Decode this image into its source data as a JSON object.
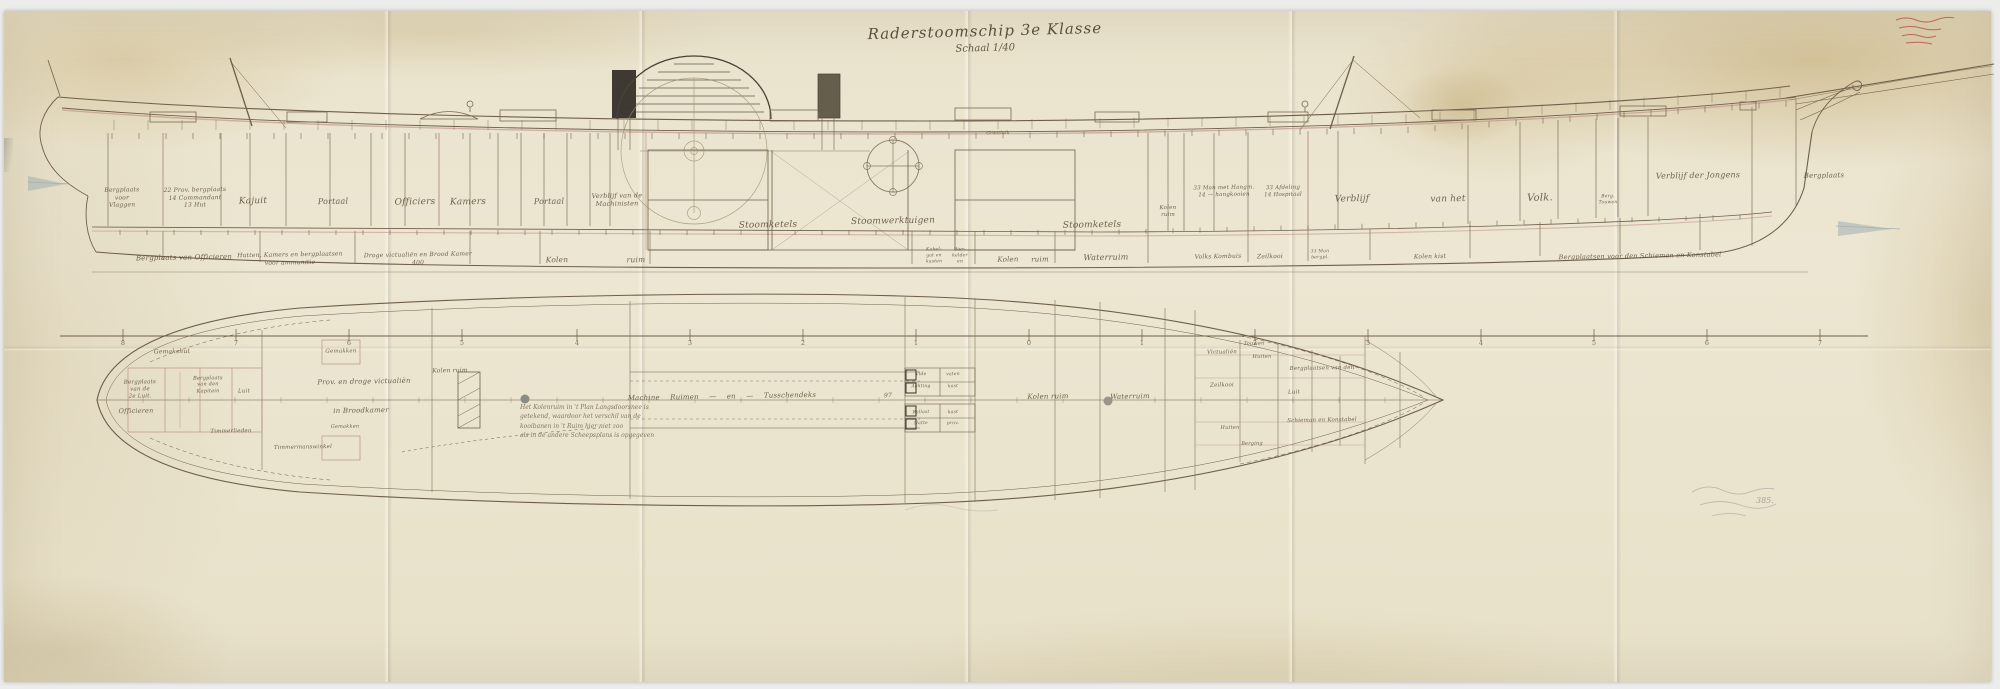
{
  "sheet": {
    "title": "Raderstoomschip 3e Klasse",
    "scale_note": "Schaal 1/40",
    "paper_color": "#e9e2cb",
    "ink_color": "#6f5f49",
    "accent_red": "#bf958c",
    "stamp_color": "#b5453a"
  },
  "profile_view": {
    "caption": "Langsdoorsnede",
    "tweendeck_labels": [
      {
        "t": "Bergplaats\nvoor\nVlaggen",
        "x": 122,
        "y": 198,
        "fs": 6
      },
      {
        "t": "22 Prov. bergplaats\n14 Commandant\n13 Hut",
        "x": 195,
        "y": 198,
        "fs": 6
      },
      {
        "t": "Kajuit",
        "x": 253,
        "y": 202,
        "fs": 9
      },
      {
        "t": "Portaal",
        "x": 333,
        "y": 202,
        "fs": 8
      },
      {
        "t": "Officiers",
        "x": 415,
        "y": 203,
        "fs": 9
      },
      {
        "t": "Kamers",
        "x": 468,
        "y": 203,
        "fs": 9
      },
      {
        "t": "Portaal",
        "x": 549,
        "y": 202,
        "fs": 8
      },
      {
        "t": "Verblijf van de\nMachinisten",
        "x": 617,
        "y": 200,
        "fs": 6.5
      },
      {
        "t": "Stoomketels",
        "x": 768,
        "y": 226,
        "fs": 9
      },
      {
        "t": "Stoomwerktuigen",
        "x": 893,
        "y": 222,
        "fs": 9
      },
      {
        "t": "Stoomketels",
        "x": 1092,
        "y": 226,
        "fs": 9
      },
      {
        "t": "Kolen\nruim",
        "x": 1168,
        "y": 212,
        "fs": 5.5
      },
      {
        "t": "33 Man met Hangm.\n14  —  hangkooien",
        "x": 1224,
        "y": 192,
        "fs": 5.5
      },
      {
        "t": "33 Afdeling\n14 Hospitaal",
        "x": 1283,
        "y": 192,
        "fs": 5.5
      },
      {
        "t": "Verblijf",
        "x": 1352,
        "y": 200,
        "fs": 9
      },
      {
        "t": "van het",
        "x": 1448,
        "y": 200,
        "fs": 9
      },
      {
        "t": "Volk.",
        "x": 1540,
        "y": 199,
        "fs": 10
      },
      {
        "t": "Berg.\nTouwen",
        "x": 1608,
        "y": 200,
        "fs": 4.5
      },
      {
        "t": "Verblijf der Jongens",
        "x": 1698,
        "y": 176,
        "fs": 8
      },
      {
        "t": "Bergplaats",
        "x": 1824,
        "y": 176,
        "fs": 7
      }
    ],
    "hold_labels": [
      {
        "t": "Bergplaats van Officieren",
        "x": 184,
        "y": 258,
        "fs": 7
      },
      {
        "t": "Hutten, Kamers en bergplaatsen\nvoor ammunitie",
        "x": 290,
        "y": 259,
        "fs": 6
      },
      {
        "t": "Droge victualiën en Brood Kamer\n400",
        "x": 418,
        "y": 259,
        "fs": 6
      },
      {
        "t": "Kolen",
        "x": 557,
        "y": 260,
        "fs": 7.5
      },
      {
        "t": "ruim",
        "x": 636,
        "y": 260,
        "fs": 7.5
      },
      {
        "t": "Kabel-\ngat en\nkasten",
        "x": 934,
        "y": 256,
        "fs": 4.5
      },
      {
        "t": "Bier-\nkelder\nen",
        "x": 960,
        "y": 256,
        "fs": 4.5
      },
      {
        "t": "Kolen",
        "x": 1008,
        "y": 260,
        "fs": 7
      },
      {
        "t": "ruim",
        "x": 1040,
        "y": 260,
        "fs": 7
      },
      {
        "t": "Waterruim",
        "x": 1106,
        "y": 258,
        "fs": 8
      },
      {
        "t": "Volks Kombuis",
        "x": 1218,
        "y": 257,
        "fs": 6
      },
      {
        "t": "Zeilkooi",
        "x": 1270,
        "y": 257,
        "fs": 6
      },
      {
        "t": "33 Man\nbergpl.",
        "x": 1320,
        "y": 255,
        "fs": 4.5
      },
      {
        "t": "Kolen kist",
        "x": 1430,
        "y": 257,
        "fs": 6
      },
      {
        "t": "Bergplaatsen voor den Schieman en Konstabel",
        "x": 1640,
        "y": 256,
        "fs": 6.5
      }
    ],
    "deck_labels": [
      {
        "t": "Grootluik",
        "x": 998,
        "y": 134,
        "fs": 4.5
      }
    ]
  },
  "station_line": {
    "y": 343,
    "numbers": [
      {
        "t": "8",
        "x": 123
      },
      {
        "t": "7",
        "x": 236
      },
      {
        "t": "6",
        "x": 349
      },
      {
        "t": "5",
        "x": 462
      },
      {
        "t": "4",
        "x": 577
      },
      {
        "t": "3",
        "x": 690
      },
      {
        "t": "2",
        "x": 803
      },
      {
        "t": "1",
        "x": 916
      },
      {
        "t": "0",
        "x": 1029
      },
      {
        "t": "1",
        "x": 1142
      },
      {
        "t": "2",
        "x": 1255
      },
      {
        "t": "3",
        "x": 1368
      },
      {
        "t": "4",
        "x": 1481
      },
      {
        "t": "5",
        "x": 1594
      },
      {
        "t": "6",
        "x": 1707
      },
      {
        "t": "7",
        "x": 1820
      }
    ]
  },
  "plan_view": {
    "caption": "Plan van het ruim",
    "labels": [
      {
        "t": "Gemakshut",
        "x": 172,
        "y": 352,
        "fs": 6
      },
      {
        "t": "Gemakken",
        "x": 341,
        "y": 352,
        "fs": 5.5
      },
      {
        "t": "Gemakken",
        "x": 345,
        "y": 427,
        "fs": 5
      },
      {
        "t": "Timmermanswinkel",
        "x": 303,
        "y": 448,
        "fs": 5.5
      },
      {
        "t": "Bergplaats\nvan de\n2e Luit.",
        "x": 140,
        "y": 390,
        "fs": 5.5
      },
      {
        "t": "Bergplaats\nvan den\nKapitein",
        "x": 208,
        "y": 385,
        "fs": 5
      },
      {
        "t": "Officieren",
        "x": 136,
        "y": 411,
        "fs": 6.5
      },
      {
        "t": "Luit",
        "x": 244,
        "y": 392,
        "fs": 5.5
      },
      {
        "t": "Timmerlieden",
        "x": 231,
        "y": 432,
        "fs": 5.5
      },
      {
        "t": "Prov. en droge victualiën",
        "x": 364,
        "y": 382,
        "fs": 7
      },
      {
        "t": "in Broodkamer",
        "x": 361,
        "y": 411,
        "fs": 7
      },
      {
        "t": "Kolen ruim",
        "x": 450,
        "y": 371,
        "fs": 6
      },
      {
        "t": "Machine Ruimen  —  en  —  Tusschendeks",
        "x": 722,
        "y": 397,
        "fs": 7,
        "ws": 8
      },
      {
        "t": "97",
        "x": 888,
        "y": 396,
        "fs": 6
      },
      {
        "t": "Vide",
        "x": 921,
        "y": 375,
        "fs": 4.5
      },
      {
        "t": "vaten",
        "x": 953,
        "y": 375,
        "fs": 4.5
      },
      {
        "t": "Achting",
        "x": 921,
        "y": 387,
        "fs": 4.5
      },
      {
        "t": "kast",
        "x": 953,
        "y": 387,
        "fs": 4.5
      },
      {
        "t": "Ballast",
        "x": 921,
        "y": 413,
        "fs": 4.5
      },
      {
        "t": "kast",
        "x": 953,
        "y": 413,
        "fs": 4.5
      },
      {
        "t": "Natte",
        "x": 921,
        "y": 424,
        "fs": 4.5
      },
      {
        "t": "prov.",
        "x": 953,
        "y": 424,
        "fs": 4.5
      },
      {
        "t": "Kolen ruim",
        "x": 1048,
        "y": 397,
        "fs": 7
      },
      {
        "t": "Waterruim",
        "x": 1130,
        "y": 397,
        "fs": 7
      },
      {
        "t": "Victualiën",
        "x": 1222,
        "y": 353,
        "fs": 5.5
      },
      {
        "t": "Touwen",
        "x": 1254,
        "y": 344,
        "fs": 5
      },
      {
        "t": "Hutten",
        "x": 1262,
        "y": 357,
        "fs": 5
      },
      {
        "t": "Bergplaatsen van den",
        "x": 1322,
        "y": 369,
        "fs": 5.5
      },
      {
        "t": "Zeilkooi",
        "x": 1222,
        "y": 386,
        "fs": 5.5
      },
      {
        "t": "Luit",
        "x": 1294,
        "y": 393,
        "fs": 5.5
      },
      {
        "t": "Schieman en Konstabel",
        "x": 1322,
        "y": 421,
        "fs": 5.5
      },
      {
        "t": "Hutten",
        "x": 1230,
        "y": 428,
        "fs": 5
      },
      {
        "t": "Berging",
        "x": 1252,
        "y": 444,
        "fs": 5
      }
    ],
    "note_lines": [
      "Het Kolenruim in 't Plan Langsdoorsnee is",
      "getekend, waardoor het verschil van de",
      "kooibanen in 't Ruim hier niet zoo",
      "als in de andere Scheepsplans is opgegeven"
    ]
  },
  "marks": {
    "pencil_number": "385.",
    "stamp_legible": "onleesbaar (rood stempelschrift)"
  }
}
